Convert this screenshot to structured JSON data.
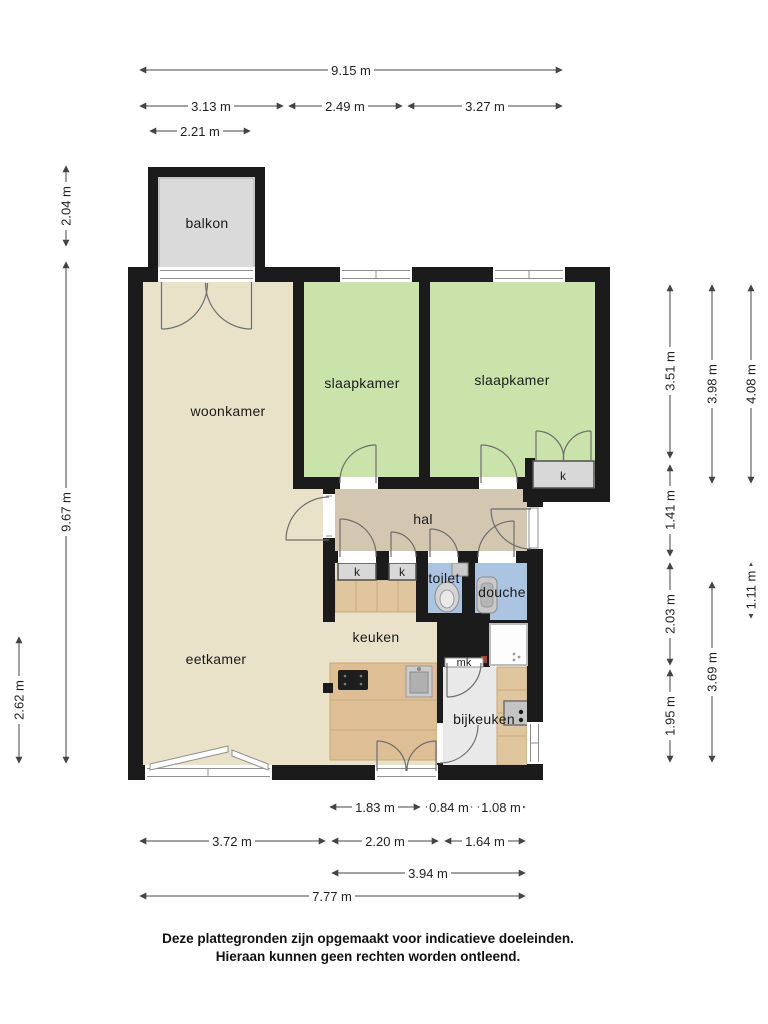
{
  "plan": {
    "rooms": {
      "balkon": "balkon",
      "woonkamer": "woonkamer",
      "slaapkamer_1": "slaapkamer",
      "slaapkamer_2": "slaapkamer",
      "hal": "hal",
      "toilet": "toilet",
      "douche": "douche",
      "keuken": "keuken",
      "eetkamer": "eetkamer",
      "bijkeuken": "bijkeuken",
      "meterkast": "mk",
      "kast_slaapkamer": "k",
      "kast_hal_1": "k",
      "kast_hal_2": "k"
    },
    "dimensions": {
      "top_full": "9.15 m",
      "top_woonkamer": "3.13 m",
      "top_slaapkamer1": "2.49 m",
      "top_slaapkamer2": "3.27 m",
      "top_balkon": "2.21 m",
      "left_balkon": "2.04 m",
      "left_full": "9.67 m",
      "left_eetkamer": "2.62 m",
      "right_slaapkamer": "3.51 m",
      "right_hal": "1.41 m",
      "right_sanitair": "2.03 m",
      "right_bijkeuken": "1.95 m",
      "right_slaapkamer_buiten": "3.98 m",
      "right_achter": "3.69 m",
      "right_breedte": "4.08 m",
      "right_toilet": "1.11 m",
      "bottom_counter": "1.83 m",
      "bottom_mk": "0.84 m",
      "bottom_tray": "1.08 m",
      "bottom_eetkamer": "3.72 m",
      "bottom_keuken": "2.20 m",
      "bottom_bijkeuken": "1.64 m",
      "bottom_rechts": "3.94 m",
      "bottom_full": "7.77 m"
    },
    "footer": {
      "line1": "Deze plattegronden zijn opgemaakt voor indicatieve doeleinden.",
      "line2": "Hieraan kunnen geen rechten worden ontleend."
    },
    "colors": {
      "wall": "#1b1b1b",
      "living": "#e9e2c8",
      "bedroom": "#c9e3aa",
      "hall": "#d4c7b1",
      "wet": "#aac4e2",
      "balcony": "#dadada",
      "closet": "#d8d8d8",
      "utility": "#e9e9e9",
      "wood_counter": "#e0c69e",
      "wood_island": "#debf95"
    }
  }
}
